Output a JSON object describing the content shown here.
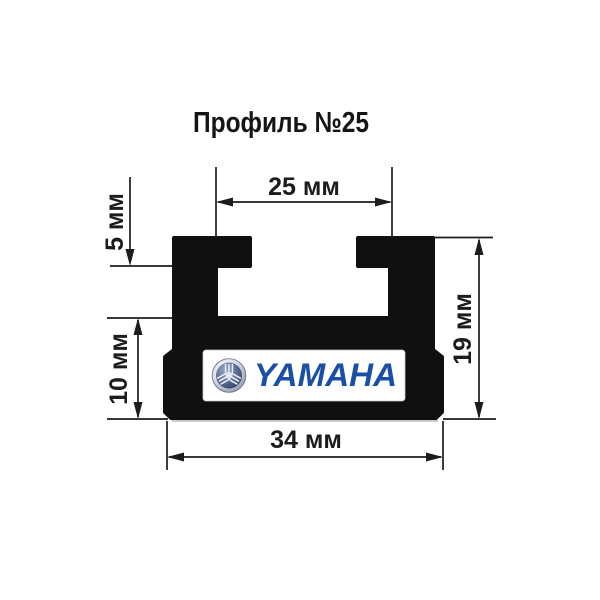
{
  "title": "Профиль №25",
  "figure": {
    "kind": "technical cross-section drawing of snowmobile slide profile",
    "dimensions": {
      "slot_width": "25 мм",
      "flange_height": "5 мм",
      "lower_height": "10 мм",
      "total_height": "19 мм",
      "base_width": "34 мм"
    },
    "logo": {
      "brand": "YAMAHA",
      "emblem_icon": "yamaha-tuning-forks"
    },
    "colors": {
      "background": "#ffffff",
      "profile": "#101010",
      "line": "#1c1c1c",
      "logo_text": "#1b4fa5",
      "logo_plate": "#ffffff"
    }
  }
}
